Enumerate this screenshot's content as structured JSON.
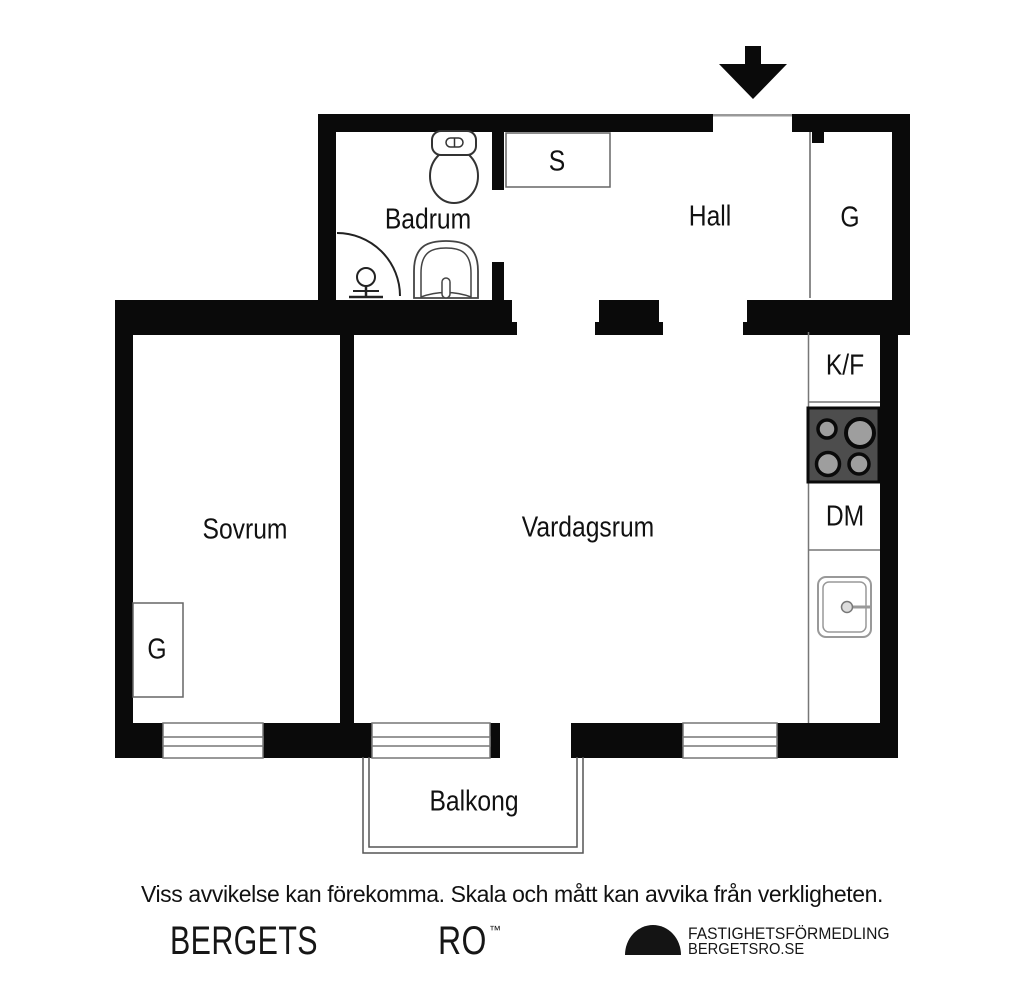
{
  "labels": {
    "badrum": "Badrum",
    "closet_s": "S",
    "hall": "Hall",
    "closet_g_hall": "G",
    "sovrum": "Sovrum",
    "vardagsrum": "Vardagsrum",
    "fridge_freezer": "K/F",
    "dishwasher": "DM",
    "closet_g_sovrum": "G",
    "balkong": "Balkong"
  },
  "icons": {
    "entrance_arrow": "down-arrow",
    "toilet": "toilet-top-view",
    "shower": "shower-corner-arc",
    "bathroom_sink": "washbasin-top-view",
    "kitchen_sink": "kitchen-sink-top-view",
    "stove": "four-burner-cooktop",
    "brand_mark": "black-half-dome"
  },
  "colors": {
    "wall": "#0a0a0a",
    "thin_line": "#777777",
    "stove_fill": "#4d4d4d",
    "burner_fill": "#9e9e9e",
    "text": "#111111"
  },
  "footer": {
    "disclaimer": "Viss avvikelse kan förekomma. Skala och mått kan avvika från verkligheten.",
    "brand_left": "BERGETS",
    "brand_right": "RO",
    "trademark": "™",
    "agency_line1": "FASTIGHETSFÖRMEDLING",
    "agency_line2": "BERGETSRO.SE"
  }
}
